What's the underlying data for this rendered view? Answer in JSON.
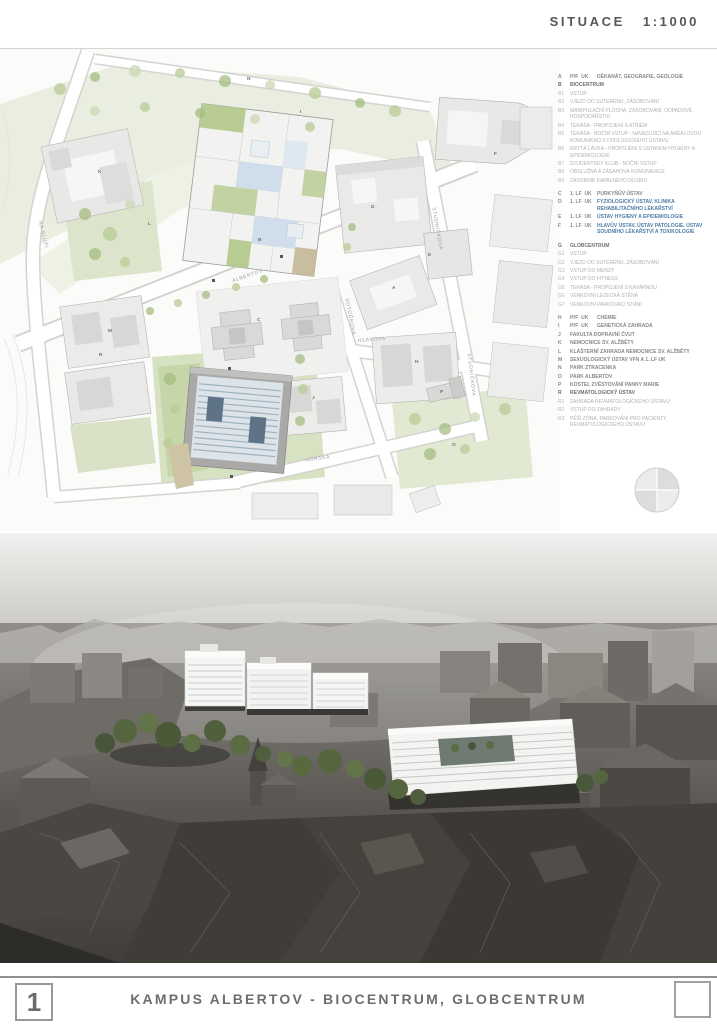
{
  "header": {
    "title": "SITUACE",
    "scale": "1:1000"
  },
  "footer": {
    "number": "1",
    "title": "KAMPUS ALBERTOV - BIOCENTRUM, GLOBCENTRUM"
  },
  "colors": {
    "accent_blue": "#4e7ca8",
    "title_gray": "#6d6e71",
    "legend_sub_gray": "#aeafb1",
    "map_park_green": "#dce5cb",
    "biocentrum_atrium_blue": "#cfdeea",
    "globcentrum_roof_blue": "#9fb2bf",
    "render_tree_green": "#5a6c44"
  },
  "map": {
    "streets": [
      "NA SLUPI",
      "ALBERTOV",
      "VOTOČKOVA",
      "HLAVOVA",
      "STUDNIČKOVA",
      "STUDNIČKOVA",
      "HORSKÁ"
    ],
    "buildings": [
      "A",
      "B",
      "C",
      "D",
      "E",
      "F",
      "G",
      "H",
      "I",
      "J",
      "K",
      "L",
      "M",
      "N",
      "O",
      "P",
      "R"
    ]
  },
  "legend": {
    "items": [
      {
        "code": "A",
        "pre": "PřF  UK",
        "text": "DĚKANÁT, GEOGRAFIE, GEOLOGIE",
        "style": "main"
      },
      {
        "code": "B",
        "pre": "",
        "text": "BIOCENTRUM",
        "style": "head"
      },
      {
        "code": "B1",
        "pre": "",
        "text": "VSTUP",
        "style": "sub"
      },
      {
        "code": "B2",
        "pre": "",
        "text": "VJEZD DO SUTERÉNU, ZÁSOBOVÁNÍ",
        "style": "sub"
      },
      {
        "code": "B3",
        "pre": "",
        "text": "MANIPULAČNÍ PLOCHA, ZÁSOBOVÁNÍ, ODPADOVÉ HOSPODÁŘSTVÍ",
        "style": "sub"
      },
      {
        "code": "B4",
        "pre": "",
        "text": "TERASA - PROPOJENÍ S ATRIEM",
        "style": "sub"
      },
      {
        "code": "B5",
        "pre": "",
        "text": "TERASA - BOČNÍ VSTUP - NAVAZUJÍCÍ NA AREÁLOVOU KOMUNIKACI FYZIOLOGICKÉHO ÚSTAVU",
        "style": "sub"
      },
      {
        "code": "B6",
        "pre": "",
        "text": "KRYTÁ LÁVKA - PROPOJENÍ S ÚSTAVEM HYGIENY A EPIDEMIOLOGIE",
        "style": "sub"
      },
      {
        "code": "B7",
        "pre": "",
        "text": "STUDENTSKÝ KLUB - NOČNÍ VSTUP",
        "style": "sub"
      },
      {
        "code": "B8",
        "pre": "",
        "text": "OBSLUŽNÁ A ZÁSAHOVÁ KOMUNIKACE",
        "style": "sub"
      },
      {
        "code": "B9",
        "pre": "",
        "text": "ZÁSOBNÍK KAPALNÉHO DUSÍKU",
        "style": "sub"
      },
      {
        "gap": true
      },
      {
        "code": "C",
        "pre": "1. LF  UK",
        "text": "PURKYŇŮV ÚSTAV",
        "style": "main"
      },
      {
        "code": "D",
        "pre": "1. LF  UK",
        "text": "FYZIOLOGICKÝ ÚSTAV, KLINIKA REHABILITAČNÍHO LÉKAŘSTVÍ",
        "style": "blue"
      },
      {
        "code": "E",
        "pre": "1. LF  UK",
        "text": "ÚSTAV HYGIENY A EPIDEMIOLOGIE",
        "style": "blue"
      },
      {
        "code": "F",
        "pre": "1. LF  UK",
        "text": "HLAVŮV ÚSTAV, ÚSTAV PATOLOGIE, ÚSTAV SOUDNÍHO LÉKAŘSTVÍ A TOXIKOLOGIE",
        "style": "blue"
      },
      {
        "gap": true
      },
      {
        "code": "G",
        "pre": "",
        "text": "GLOBCENTRUM",
        "style": "head"
      },
      {
        "code": "G1",
        "pre": "",
        "text": "VSTUP",
        "style": "sub"
      },
      {
        "code": "G2",
        "pre": "",
        "text": "VJEZD DO SUTERÉNU, ZÁSOBOVÁNÍ",
        "style": "sub"
      },
      {
        "code": "G3",
        "pre": "",
        "text": "VSTUP DO MENZY",
        "style": "sub"
      },
      {
        "code": "G4",
        "pre": "",
        "text": "VSTUP DO FITNESS",
        "style": "sub"
      },
      {
        "code": "G5",
        "pre": "",
        "text": "TERASA - PROPOJENÍ S KAVÁRNOU",
        "style": "sub"
      },
      {
        "code": "G6",
        "pre": "",
        "text": "VENKOVNÍ LEZECKÁ STĚNA",
        "style": "sub"
      },
      {
        "code": "G7",
        "pre": "",
        "text": "VENKOVNÍ PARKOVACÍ STÁNÍ",
        "style": "sub"
      },
      {
        "gap": true
      },
      {
        "code": "H",
        "pre": "PřF  UK",
        "text": "CHEMIE",
        "style": "main"
      },
      {
        "code": "I",
        "pre": "PřF  UK",
        "text": "GENETICKÁ ZAHRADA",
        "style": "main"
      },
      {
        "code": "J",
        "pre": "",
        "text": "FAKULTA DOPRAVNÍ ČVUT",
        "style": "main"
      },
      {
        "code": "K",
        "pre": "",
        "text": "NEMOCNICE SV. ALŽBĚTY",
        "style": "main"
      },
      {
        "code": "L",
        "pre": "",
        "text": "KLÁŠTERNÍ ZAHRADA NEMOCNICE SV. ALŽBĚTY",
        "style": "main"
      },
      {
        "code": "M",
        "pre": "",
        "text": "SEXUOLOGICKÝ ÚSTAV VFN A 1. LF UK",
        "style": "main"
      },
      {
        "code": "N",
        "pre": "",
        "text": "PARK ZTRACENKA",
        "style": "main"
      },
      {
        "code": "O",
        "pre": "",
        "text": "PARK ALBERTOV",
        "style": "main"
      },
      {
        "code": "P",
        "pre": "",
        "text": "KOSTEL ZVĚSTOVÁNÍ PANNY MARIE",
        "style": "main"
      },
      {
        "code": "R",
        "pre": "",
        "text": "REVMATOLOGICKÝ ÚSTAV",
        "style": "head"
      },
      {
        "code": "R1",
        "pre": "",
        "text": "ZAHRADA REVMATOLOGICKÉHO ÚSTAVU",
        "style": "sub"
      },
      {
        "code": "R2",
        "pre": "",
        "text": "VSTUP DO ZAHRADY",
        "style": "sub"
      },
      {
        "code": "R3",
        "pre": "",
        "text": "PĚŠÍ ZÓNA, PARKOVÁNÍ PRO PACIENTY REVMATOLOGICKÉHO ÚSTAVU",
        "style": "sub"
      }
    ]
  }
}
